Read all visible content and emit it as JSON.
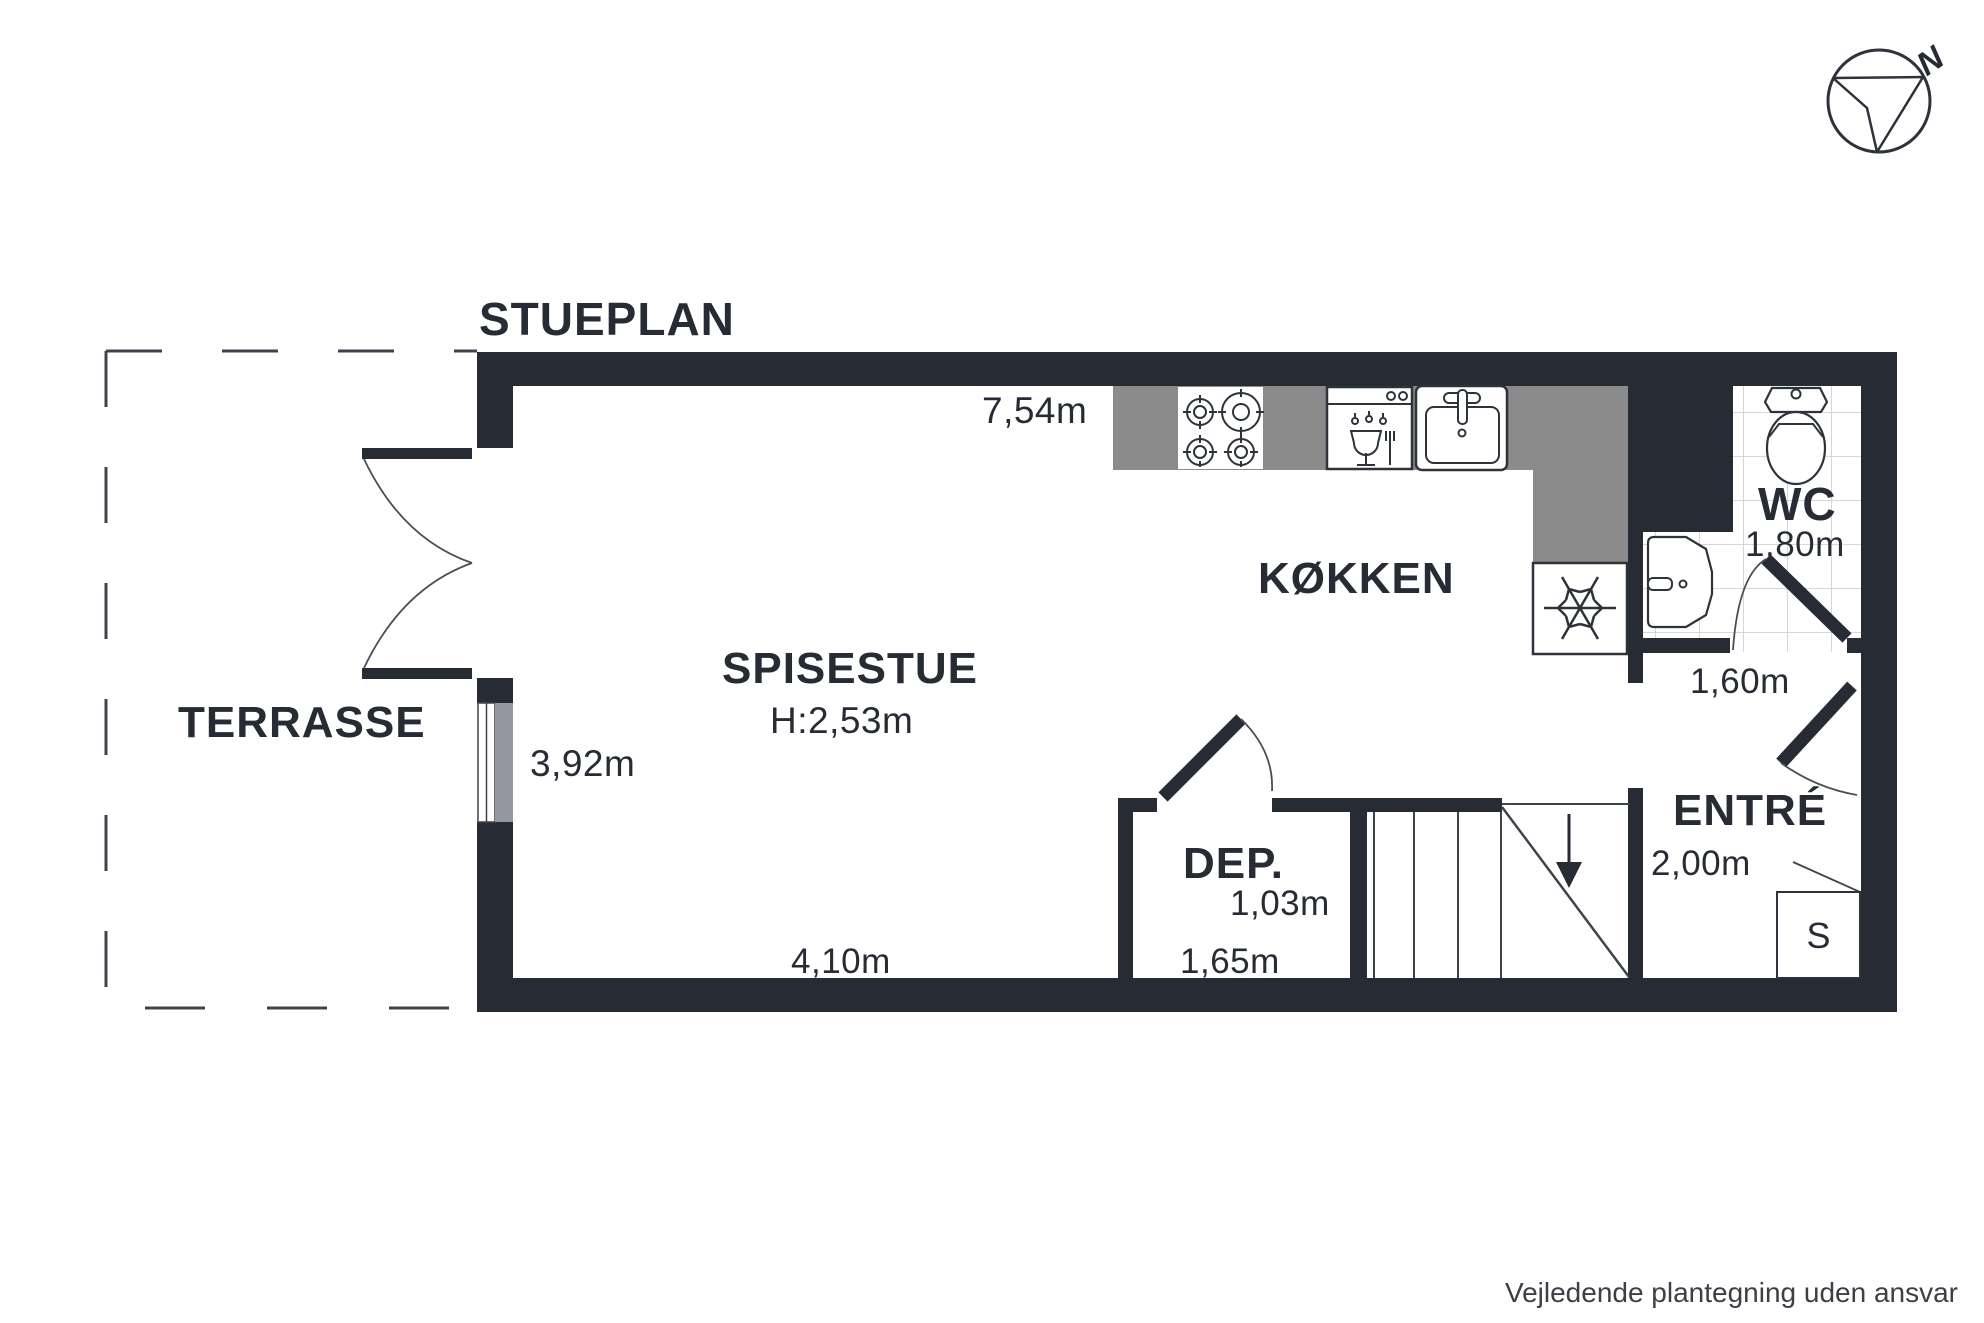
{
  "title": "STUEPLAN",
  "compass": {
    "north_label": "N"
  },
  "rooms": {
    "terrasse": {
      "label": "TERRASSE"
    },
    "spisestue": {
      "label": "SPISESTUE",
      "ceiling_height": "H:2,53m"
    },
    "kokken": {
      "label": "KØKKEN"
    },
    "wc": {
      "label": "WC",
      "width": "1,80m",
      "door_width": "1,60m"
    },
    "dep": {
      "label": "DEP.",
      "width": "1,03m",
      "bottom_width": "1,65m"
    },
    "entre": {
      "label": "ENTRÉ",
      "width": "2,00m"
    },
    "closet": {
      "label": "S"
    }
  },
  "measurements": {
    "kitchen_top": "7,54m",
    "left_side": "3,92m",
    "bottom": "4,10m"
  },
  "fixtures": [
    "stove",
    "dishwasher",
    "sink",
    "freezer",
    "toilet",
    "washbasin",
    "stairs-down",
    "closet"
  ],
  "footer": "Vejledende plantegning uden ansvar",
  "colors": {
    "wall": "#272C34",
    "counter": "#8B8B8B",
    "window_pane": "#94979B",
    "tile_line": "#C9CCCE",
    "thin_line": "#4A4F57",
    "footer_text": "#3B4046"
  }
}
